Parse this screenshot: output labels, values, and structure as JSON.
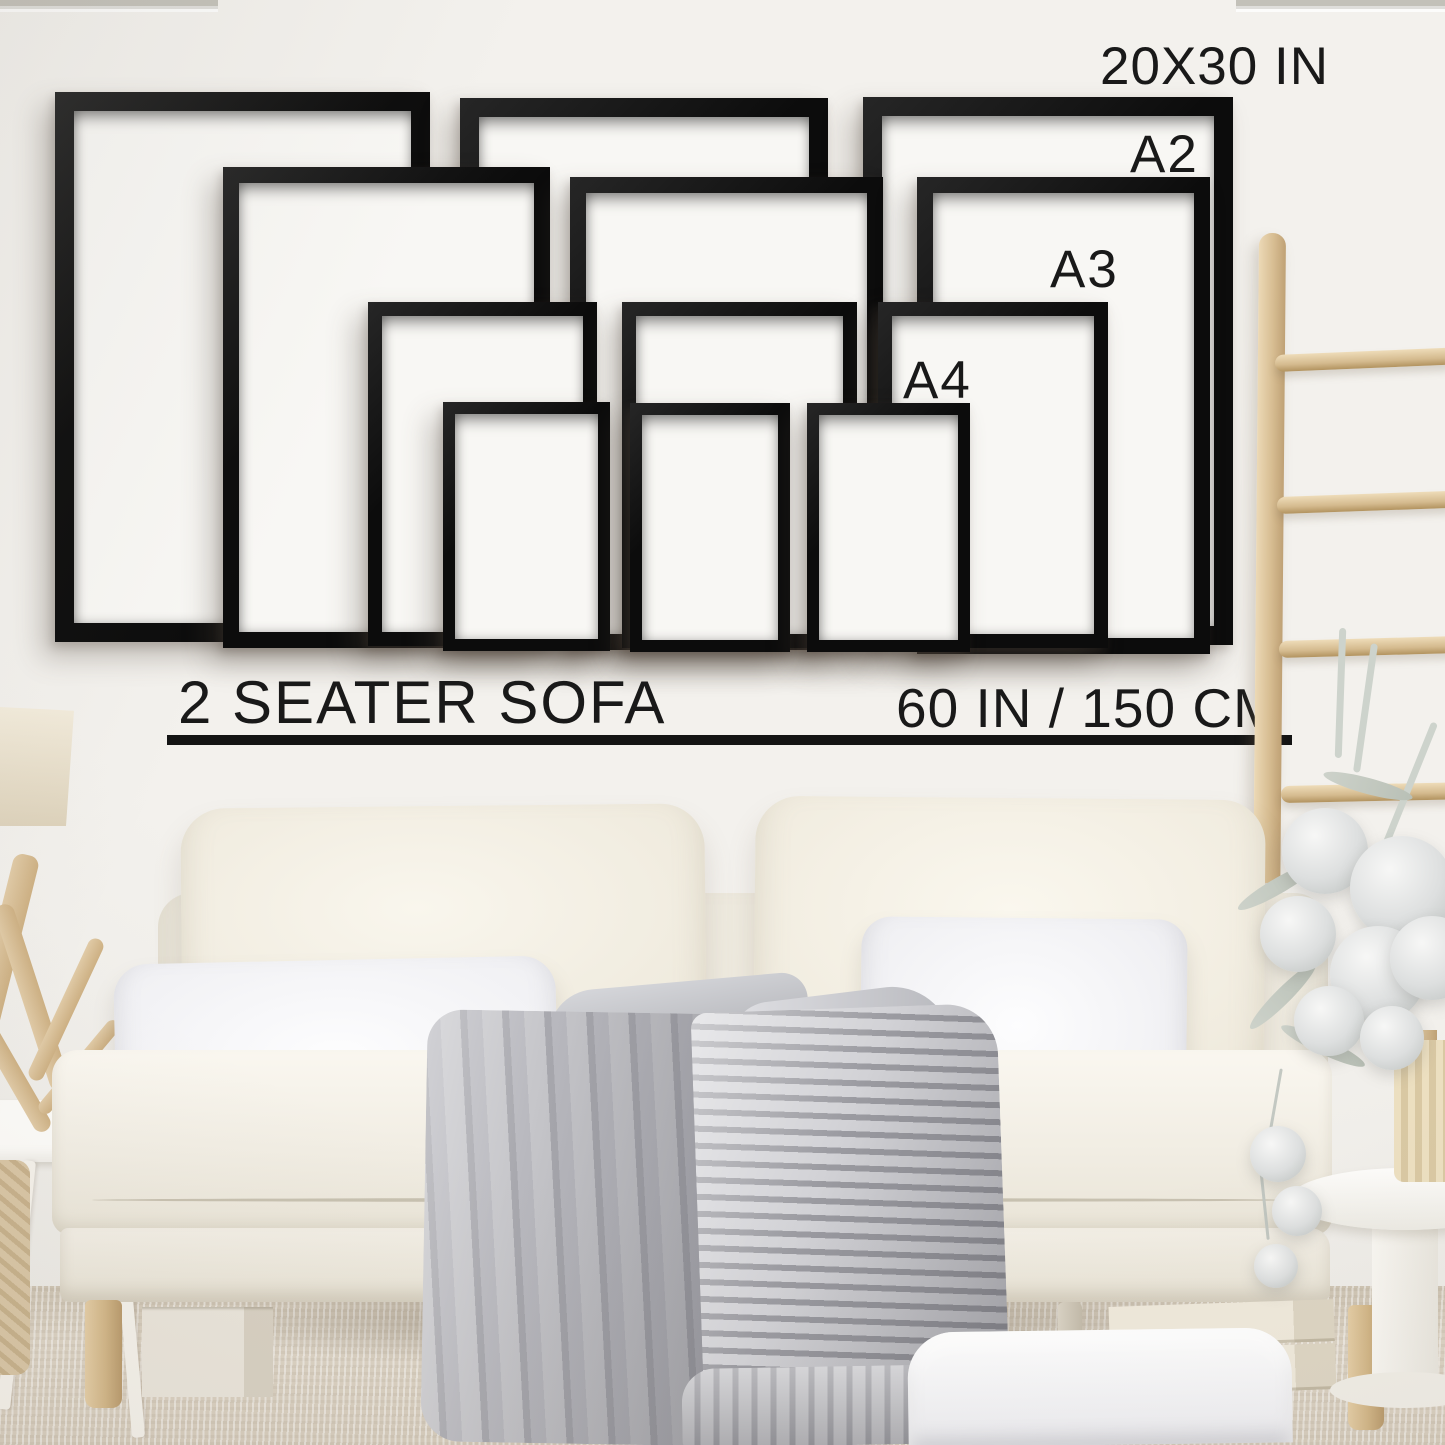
{
  "meta": {
    "description": "Wall-art frame size guide mockup above a two seater sofa",
    "scene": "living room with white sofa, wooden ladder, flowers and decor"
  },
  "size_guide": {
    "labels": [
      {
        "id": "20x30",
        "text": "20X30 IN"
      },
      {
        "id": "a2",
        "text": "A2"
      },
      {
        "id": "a3",
        "text": "A3"
      },
      {
        "id": "a4",
        "text": "A4"
      }
    ],
    "frames": [
      {
        "size": "20X30 IN",
        "position": "left"
      },
      {
        "size": "20X30 IN",
        "position": "middle"
      },
      {
        "size": "20X30 IN",
        "position": "right"
      },
      {
        "size": "A2",
        "position": "left"
      },
      {
        "size": "A2",
        "position": "middle"
      },
      {
        "size": "A2",
        "position": "right"
      },
      {
        "size": "A3",
        "position": "left"
      },
      {
        "size": "A3",
        "position": "middle"
      },
      {
        "size": "A3",
        "position": "right"
      },
      {
        "size": "A4",
        "position": "left"
      },
      {
        "size": "A4",
        "position": "middle"
      },
      {
        "size": "A4",
        "position": "right"
      }
    ]
  },
  "sofa": {
    "label": "2 SEATER SOFA",
    "width_label": "60 IN / 150 CM"
  },
  "colors": {
    "wall": "#f0eeea",
    "frame": "#0c0c0c",
    "mat": "#f8f7f4",
    "text": "#191919",
    "wood": "#d7bd92",
    "carpet": "#d6ccbc",
    "blanket": "#b9b9bf",
    "sofa": "#f1ede3"
  }
}
